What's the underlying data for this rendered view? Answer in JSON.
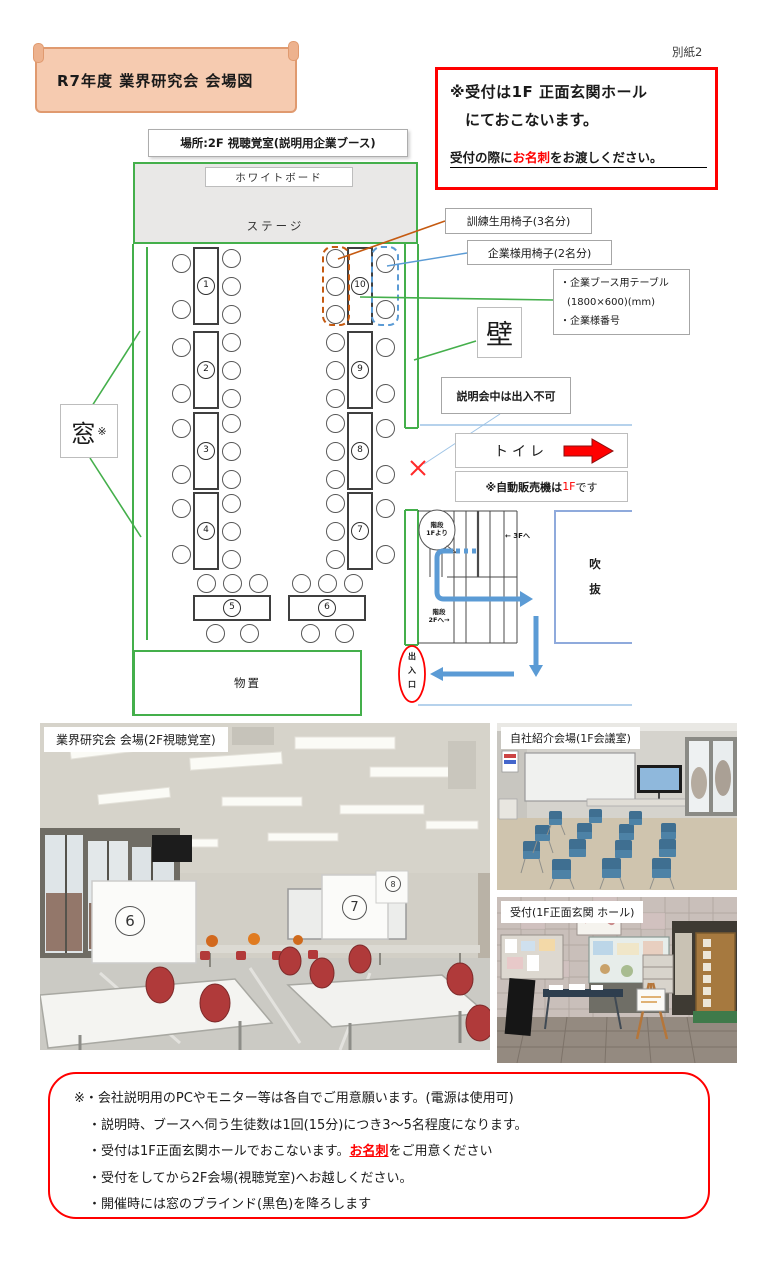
{
  "page": {
    "attachment_label": "別紙2"
  },
  "header": {
    "title": "R7年度 業界研究会 会場図",
    "notice": {
      "line1": "※受付は1F 正面玄関ホール",
      "line2": "にておこないます。",
      "line3_pre": "受付の際に",
      "line3_em": "お名刺",
      "line3_post": "をお渡しください。"
    }
  },
  "floor_plan": {
    "place_label": "場所:2F 視聴覚室(説明用企業ブース)",
    "whiteboard_label": "ホワイトボード",
    "stage_label": "ステージ",
    "window_label": "窓",
    "window_mark": "※",
    "wall_label": "壁",
    "storage_label": "物置",
    "toilet_label": "トイレ",
    "no_entry_label": "説明会中は出入不可",
    "vending": {
      "pre": "※自動販売機は",
      "em": "1F",
      "post": "です"
    },
    "legend": {
      "trainee_chairs": "訓練生用椅子(3名分)",
      "company_chairs": "企業様用椅子(2名分)",
      "booth_lines": [
        "・企業ブース用テーブル",
        "(1800×600)(mm)",
        "・企業様番号"
      ]
    },
    "tables": [
      {
        "num": "1"
      },
      {
        "num": "2"
      },
      {
        "num": "3"
      },
      {
        "num": "4"
      },
      {
        "num": "5"
      },
      {
        "num": "6"
      },
      {
        "num": "7"
      },
      {
        "num": "8"
      },
      {
        "num": "9"
      },
      {
        "num": "10"
      }
    ],
    "stairs": {
      "from_1f": [
        "階段",
        "1Fより"
      ],
      "to_3f": "← 3Fへ",
      "to_2f": [
        "階段",
        "2Fへ→"
      ]
    },
    "void_chars": [
      "吹",
      "抜"
    ],
    "entrance_chars": [
      "出",
      "入",
      "口"
    ]
  },
  "photos": [
    {
      "caption": "業界研究会 会場(2F視聴覚室)",
      "signs": [
        "6",
        "7",
        "8"
      ]
    },
    {
      "caption": "自社紹介会場(1F会議室)"
    },
    {
      "caption": "受付(1F正面玄関 ホール)"
    }
  ],
  "notes": [
    {
      "pre": "※・会社説明用のPCやモニター等は各自でご用意願います。(電源は使用可)",
      "em": "",
      "post": ""
    },
    {
      "pre": "・説明時、ブースへ伺う生徒数は1回(15分)につき3〜5名程度になります。",
      "em": "",
      "post": ""
    },
    {
      "pre": "・受付は1F正面玄関ホールでおこないます。",
      "em": "お名刺",
      "post": "をご用意ください"
    },
    {
      "pre": "・受付をしてから2F会場(視聴覚室)へお越しください。",
      "em": "",
      "post": ""
    },
    {
      "pre": "・開催時には窓のブラインド(黒色)を降ろします",
      "em": "",
      "post": ""
    }
  ],
  "colors": {
    "wall_green": "#44af4b",
    "accent_red": "#ff0000",
    "trainee_orange": "#c55a11",
    "company_blue": "#5b9bd5",
    "route_blue": "#5b9bd5",
    "void_blue": "#8faadc"
  }
}
